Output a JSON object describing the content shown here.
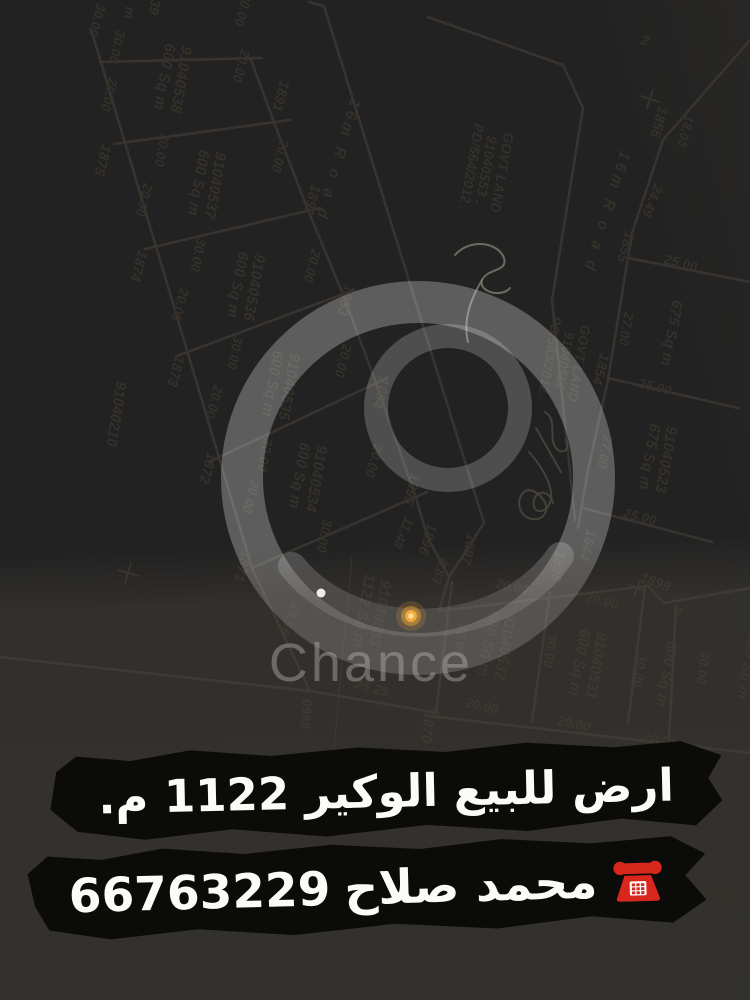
{
  "listing": {
    "line1": "ارض للبيع الوكير 1122 م.",
    "contact_name": "محمد صلاح",
    "phone": "66763229"
  },
  "watermark": {
    "text": "Chance"
  },
  "colors": {
    "ink": "#3a3530",
    "pencil": "#8a8376",
    "signature": "#4a453c",
    "marker_yellow": "#f2a93b",
    "phone_red": "#d8281e"
  },
  "plan": {
    "labels": [
      {
        "t": "30.00",
        "x": 97,
        "y": 20,
        "r": 105,
        "s": 13.5
      },
      {
        "t": "m",
        "x": 129,
        "y": 13,
        "r": 100,
        "s": 14
      },
      {
        "t": "39",
        "x": 154,
        "y": 7,
        "r": 100,
        "s": 14
      },
      {
        "t": "20.00",
        "x": 243,
        "y": 10,
        "r": 105,
        "s": 13.5
      },
      {
        "t": "30.00",
        "x": 117,
        "y": 47,
        "r": 103,
        "s": 13.5
      },
      {
        "t": "20.00",
        "x": 109,
        "y": 95,
        "r": 105,
        "s": 13.5
      },
      {
        "t": "1875",
        "x": 102,
        "y": 160,
        "r": 105,
        "s": 14.5
      },
      {
        "t": "20.00",
        "x": 144,
        "y": 200,
        "r": 105,
        "s": 13.5
      },
      {
        "t": "1874",
        "x": 138,
        "y": 266,
        "r": 105,
        "s": 14.5
      },
      {
        "t": "20.00",
        "x": 180,
        "y": 305,
        "r": 105,
        "s": 13.5
      },
      {
        "t": "1873",
        "x": 175,
        "y": 371,
        "r": 105,
        "s": 14.5
      },
      {
        "t": "20.00",
        "x": 214,
        "y": 402,
        "r": 105,
        "s": 13.5
      },
      {
        "t": "1872",
        "x": 207,
        "y": 468,
        "r": 105,
        "s": 14.5
      },
      {
        "t": "20.00",
        "x": 251,
        "y": 497,
        "r": 105,
        "s": 13.5
      },
      {
        "t": "1871",
        "x": 242,
        "y": 566,
        "r": 105,
        "s": 14.5
      },
      {
        "t": "91040210",
        "x": 115,
        "y": 414,
        "r": 99,
        "s": 15
      },
      {
        "t": "30.00",
        "x": 162,
        "y": 150,
        "r": 101,
        "s": 13.5
      },
      {
        "t": "30.00",
        "x": 198,
        "y": 255,
        "r": 101,
        "s": 13.5
      },
      {
        "t": "30.00",
        "x": 235,
        "y": 353,
        "r": 101,
        "s": 13.5
      },
      {
        "t": "30.00",
        "x": 265,
        "y": 455,
        "r": 101,
        "s": 13.5
      },
      {
        "t": "30.00",
        "x": 324,
        "y": 536,
        "r": 101,
        "s": 13.5
      },
      {
        "t": "20.00",
        "x": 241,
        "y": 66,
        "r": 105,
        "s": 13.5
      },
      {
        "t": "1891",
        "x": 280,
        "y": 96,
        "r": 105,
        "s": 14.5
      },
      {
        "t": "20.00",
        "x": 280,
        "y": 156,
        "r": 105,
        "s": 13.5
      },
      {
        "t": "1892",
        "x": 311,
        "y": 200,
        "r": 105,
        "s": 14.5
      },
      {
        "t": "20.00",
        "x": 312,
        "y": 266,
        "r": 105,
        "s": 13.5
      },
      {
        "t": "1893",
        "x": 345,
        "y": 300,
        "r": 105,
        "s": 14.5
      },
      {
        "t": "20.00",
        "x": 343,
        "y": 361,
        "r": 105,
        "s": 13.5
      },
      {
        "t": "1894",
        "x": 380,
        "y": 393,
        "r": 105,
        "s": 14.5
      },
      {
        "t": "20.00",
        "x": 374,
        "y": 461,
        "r": 105,
        "s": 13.5
      },
      {
        "t": "1895",
        "x": 411,
        "y": 489,
        "r": 105,
        "s": 14.5
      },
      {
        "t": "11.48",
        "x": 403,
        "y": 533,
        "r": 113,
        "s": 13.5
      },
      {
        "t": "1896",
        "x": 427,
        "y": 539,
        "r": 108,
        "s": 14.5
      },
      {
        "t": "8.83",
        "x": 440,
        "y": 571,
        "r": 108,
        "s": 13.5
      },
      {
        "t": "1897",
        "x": 468,
        "y": 549,
        "r": 103,
        "s": 14.5
      },
      {
        "t": "28.58",
        "x": 290,
        "y": 619,
        "r": 113,
        "s": 13.5
      },
      {
        "t": "25.25",
        "x": 372,
        "y": 688,
        "r": 16,
        "s": 13.5
      },
      {
        "t": "0988",
        "x": 306,
        "y": 714,
        "r": 96,
        "s": 13.5
      },
      {
        "t": "1870",
        "x": 427,
        "y": 727,
        "r": 97,
        "s": 14.5
      },
      {
        "t": "16m R o a d",
        "x": 337,
        "y": 160,
        "r": 106,
        "s": 16,
        "ls": 4
      },
      {
        "t": "16m R o a d",
        "x": 606,
        "y": 212,
        "r": 107,
        "s": 16,
        "ls": 4
      },
      {
        "t": "20.00",
        "x": 512,
        "y": 587,
        "r": 13,
        "s": 13.5
      },
      {
        "t": "1898",
        "x": 557,
        "y": 566,
        "r": 99,
        "s": 14.5
      },
      {
        "t": "20.00",
        "x": 602,
        "y": 601,
        "r": 13,
        "s": 13.5
      },
      {
        "t": "1899",
        "x": 655,
        "y": 583,
        "r": 20,
        "s": 14.5
      },
      {
        "t": "2",
        "x": 679,
        "y": 613,
        "r": 15,
        "s": 13
      },
      {
        "t": "30.00",
        "x": 461,
        "y": 640,
        "r": 99,
        "s": 13.5
      },
      {
        "t": "30.00",
        "x": 550,
        "y": 651,
        "r": 99,
        "s": 13.5
      },
      {
        "t": "30.00",
        "x": 640,
        "y": 671,
        "r": 99,
        "s": 13.5
      },
      {
        "t": "30.00",
        "x": 703,
        "y": 668,
        "r": 99,
        "s": 13.5
      },
      {
        "t": "20.00",
        "x": 482,
        "y": 706,
        "r": 13,
        "s": 13.5
      },
      {
        "t": "20.00",
        "x": 574,
        "y": 724,
        "r": 13,
        "s": 13.5
      },
      {
        "t": "20.01",
        "x": 660,
        "y": 740,
        "r": 13,
        "s": 13.5
      },
      {
        "t": "2",
        "x": 645,
        "y": 41,
        "r": 15,
        "s": 14
      },
      {
        "t": "1856",
        "x": 658,
        "y": 122,
        "r": 105,
        "s": 14.5
      },
      {
        "t": "18.03",
        "x": 685,
        "y": 131,
        "r": 105,
        "s": 13
      },
      {
        "t": "24.49",
        "x": 652,
        "y": 201,
        "r": 112,
        "s": 13.5
      },
      {
        "t": "1855",
        "x": 625,
        "y": 247,
        "r": 105,
        "s": 14.5
      },
      {
        "t": "25.00",
        "x": 681,
        "y": 263,
        "r": 14,
        "s": 13.5
      },
      {
        "t": "27.00",
        "x": 626,
        "y": 329,
        "r": 100,
        "s": 13.5
      },
      {
        "t": "25.00",
        "x": 655,
        "y": 387,
        "r": 14,
        "s": 13.5
      },
      {
        "t": "1854",
        "x": 600,
        "y": 369,
        "r": 105,
        "s": 14.5
      },
      {
        "t": "27.00",
        "x": 605,
        "y": 452,
        "r": 100,
        "s": 13.5
      },
      {
        "t": "25.00",
        "x": 640,
        "y": 517,
        "r": 14,
        "s": 13.5
      },
      {
        "t": "1844",
        "x": 587,
        "y": 545,
        "r": 105,
        "s": 14.5
      }
    ],
    "blocks": [
      {
        "lines": [
          "91040538",
          "600 Sq m"
        ],
        "x": 172,
        "y": 78,
        "r": 100,
        "s": 15.5
      },
      {
        "lines": [
          "91040537",
          "600 Sq m"
        ],
        "x": 206,
        "y": 184,
        "r": 100,
        "s": 15.5
      },
      {
        "lines": [
          "91040536",
          "600 Sq m"
        ],
        "x": 245,
        "y": 286,
        "r": 100,
        "s": 15.5
      },
      {
        "lines": [
          "91040535",
          "600 Sq m"
        ],
        "x": 280,
        "y": 385,
        "r": 100,
        "s": 15.5
      },
      {
        "lines": [
          "91040534",
          "600 Sq m"
        ],
        "x": 307,
        "y": 477,
        "r": 100,
        "s": 15.5
      },
      {
        "lines": [
          "91040533",
          "1122 Sq m"
        ],
        "x": 371,
        "y": 612,
        "r": 100,
        "s": 15.5
      },
      {
        "lines": [
          "GOVT LAND",
          "91040553 .",
          "PD/564/2012 ."
        ],
        "x": 486,
        "y": 170,
        "r": 100,
        "s": 14
      },
      {
        "lines": [
          "GOVT LAND",
          "91040552",
          "PD/563/2012 ."
        ],
        "x": 564,
        "y": 361,
        "r": 100,
        "s": 13.5
      },
      {
        "lines": [
          "675 Sq m"
        ],
        "x": 671,
        "y": 333,
        "r": 100,
        "s": 15.5
      },
      {
        "lines": [
          "91040523",
          "675 Sq m"
        ],
        "x": 657,
        "y": 458,
        "r": 100,
        "s": 15.5
      },
      {
        "lines": [
          "91040532",
          "600 Sq m"
        ],
        "x": 496,
        "y": 645,
        "r": 100,
        "s": 15.5
      },
      {
        "lines": [
          "91040531",
          "600 Sq m"
        ],
        "x": 587,
        "y": 664,
        "r": 100,
        "s": 15.5
      },
      {
        "lines": [
          "600 Sq m"
        ],
        "x": 666,
        "y": 674,
        "r": 100,
        "s": 15.5
      },
      {
        "lines": [
          "600 Sq m"
        ],
        "x": 747,
        "y": 666,
        "r": 100,
        "s": 15.5,
        "o": 0.8
      }
    ],
    "paths": [
      "M 91,29 L 252,568",
      "M 252,568 L 310,691",
      "M 0,657 L 310,691 L 438,713",
      "M 251,60 L 275,125 L 308,210 L 342,292 L 375,380 L 415,495 L 428,538 L 449,577",
      "M 100,62 L 262,58",
      "M 114,144 L 290,120",
      "M 145,249 L 320,208",
      "M 177,356 L 354,290",
      "M 209,462 L 387,378",
      "M 252,568 L 427,492",
      "M 309,2 L 324,6 L 484,523 L 449,577 L 439,611 L 648,586 L 664,603 L 750,588",
      "M 428,17 L 563,65 L 583,108 L 552,300 L 575,520",
      "M 750,40 L 663,140",
      "M 663,140 L 632,233 L 608,380 L 588,470 L 578,528",
      "M 628,258 L 750,282",
      "M 608,378 L 738,408",
      "M 583,508 L 712,542",
      "M 452,582 L 436,712",
      "M 550,593 L 532,722",
      "M 645,586 L 628,723",
      "M 676,606 L 669,740",
      "M 430,716 L 750,753"
    ],
    "crosses": [
      "M 118,570 L 138,576 M 131,563 L 125,583",
      "M 641,96 L 659,102 M 653,90 L 647,108",
      "M 629,585 L 645,591 M 640,580 L 634,596"
    ],
    "leader": "M 352,556 L 332,768",
    "pencil_squiggles": [
      "M 455,255 C 470,238 498,242 504,258 C 508,272 488,268 482,280 C 478,292 502,298 510,288",
      "M 482,280 C 470,300 463,322 468,342"
    ],
    "signature_squiggles": [
      "M 545,412 C 558,420 548,438 556,448 C 562,456 571,449 566,440",
      "M 536,428 L 561,472",
      "M 529,452 C 545,470 556,492 549,505 C 543,515 531,512 534,500 C 537,488 551,492 553,503",
      "M 524,492 C 515,500 519,517 532,519 C 545,521 551,508 542,498 C 536,491 529,488 524,492"
    ],
    "dots": {
      "highlight": {
        "x": 411,
        "y": 616
      },
      "white": {
        "x": 321,
        "y": 593
      }
    }
  }
}
